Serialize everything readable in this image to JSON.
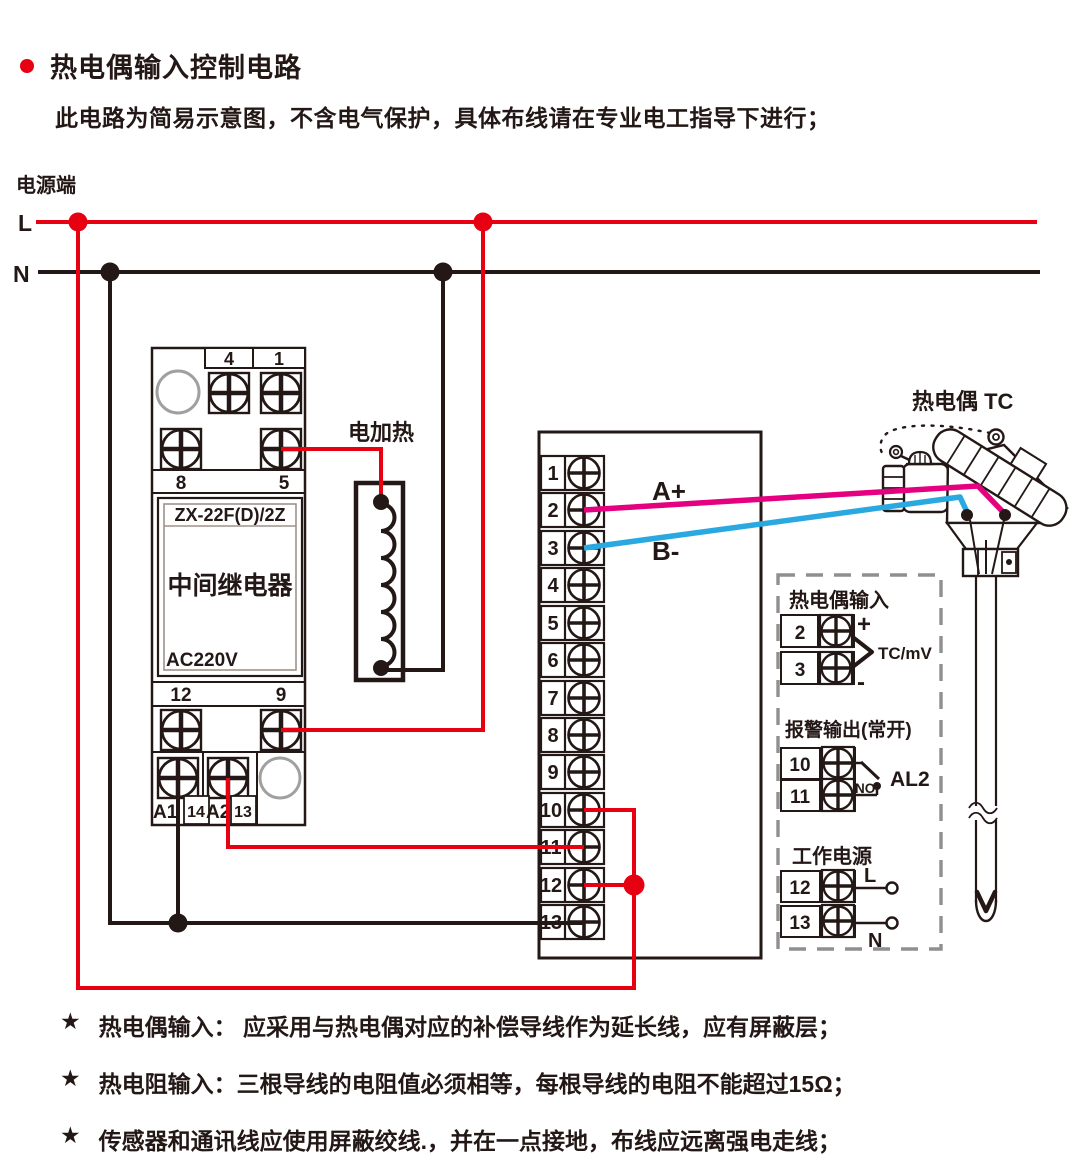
{
  "header": {
    "title": "热电偶输入控制电路",
    "subtitle": "此电路为简易示意图，不含电气保护，具体布线请在专业电工指导下进行；"
  },
  "power": {
    "label": "电源端",
    "live": "L",
    "neutral": "N"
  },
  "relay": {
    "model": "ZX-22F(D)/2Z",
    "name": "中间继电器",
    "voltage": "AC220V",
    "t4": "4",
    "t1": "1",
    "t8": "8",
    "t5": "5",
    "t12": "12",
    "t9": "9",
    "a1": "A1",
    "t14": "14",
    "a2": "A2",
    "t13": "13"
  },
  "heater": {
    "label": "电加热"
  },
  "strip": {
    "terminals": [
      "1",
      "2",
      "3",
      "4",
      "5",
      "6",
      "7",
      "8",
      "9",
      "10",
      "11",
      "12",
      "13"
    ]
  },
  "signals": {
    "a_plus": "A+",
    "b_minus": "B-"
  },
  "tc": {
    "label": "热电偶 TC"
  },
  "panel": {
    "tc_input": {
      "title": "热电偶输入",
      "t2": "2",
      "t3": "3",
      "plus": "+",
      "minus": "-",
      "tag": "TC/mV"
    },
    "alarm": {
      "title": "报警输出(常开)",
      "t10": "10",
      "t11": "11",
      "no": "NO",
      "tag": "AL2"
    },
    "supply": {
      "title": "工作电源",
      "t12": "12",
      "t13": "13",
      "live": "L",
      "neutral": "N"
    }
  },
  "notes": [
    {
      "star": "★",
      "text": "热电偶输入： 应采用与热电偶对应的补偿导线作为延长线，应有屏蔽层；"
    },
    {
      "star": "★",
      "text": "热电阻输入：三根导线的电阻值必须相等，每根导线的电阻不能超过15Ω；"
    },
    {
      "star": "★",
      "text": "传感器和通讯线应使用屏蔽绞线.，并在一点接地，布线应远离强电走线；"
    }
  ],
  "colors": {
    "line_red": "#e60012",
    "wire_pink": "#e4007f",
    "wire_blue": "#2aa9e0",
    "ink": "#231815",
    "gray": "#9fa0a0"
  }
}
